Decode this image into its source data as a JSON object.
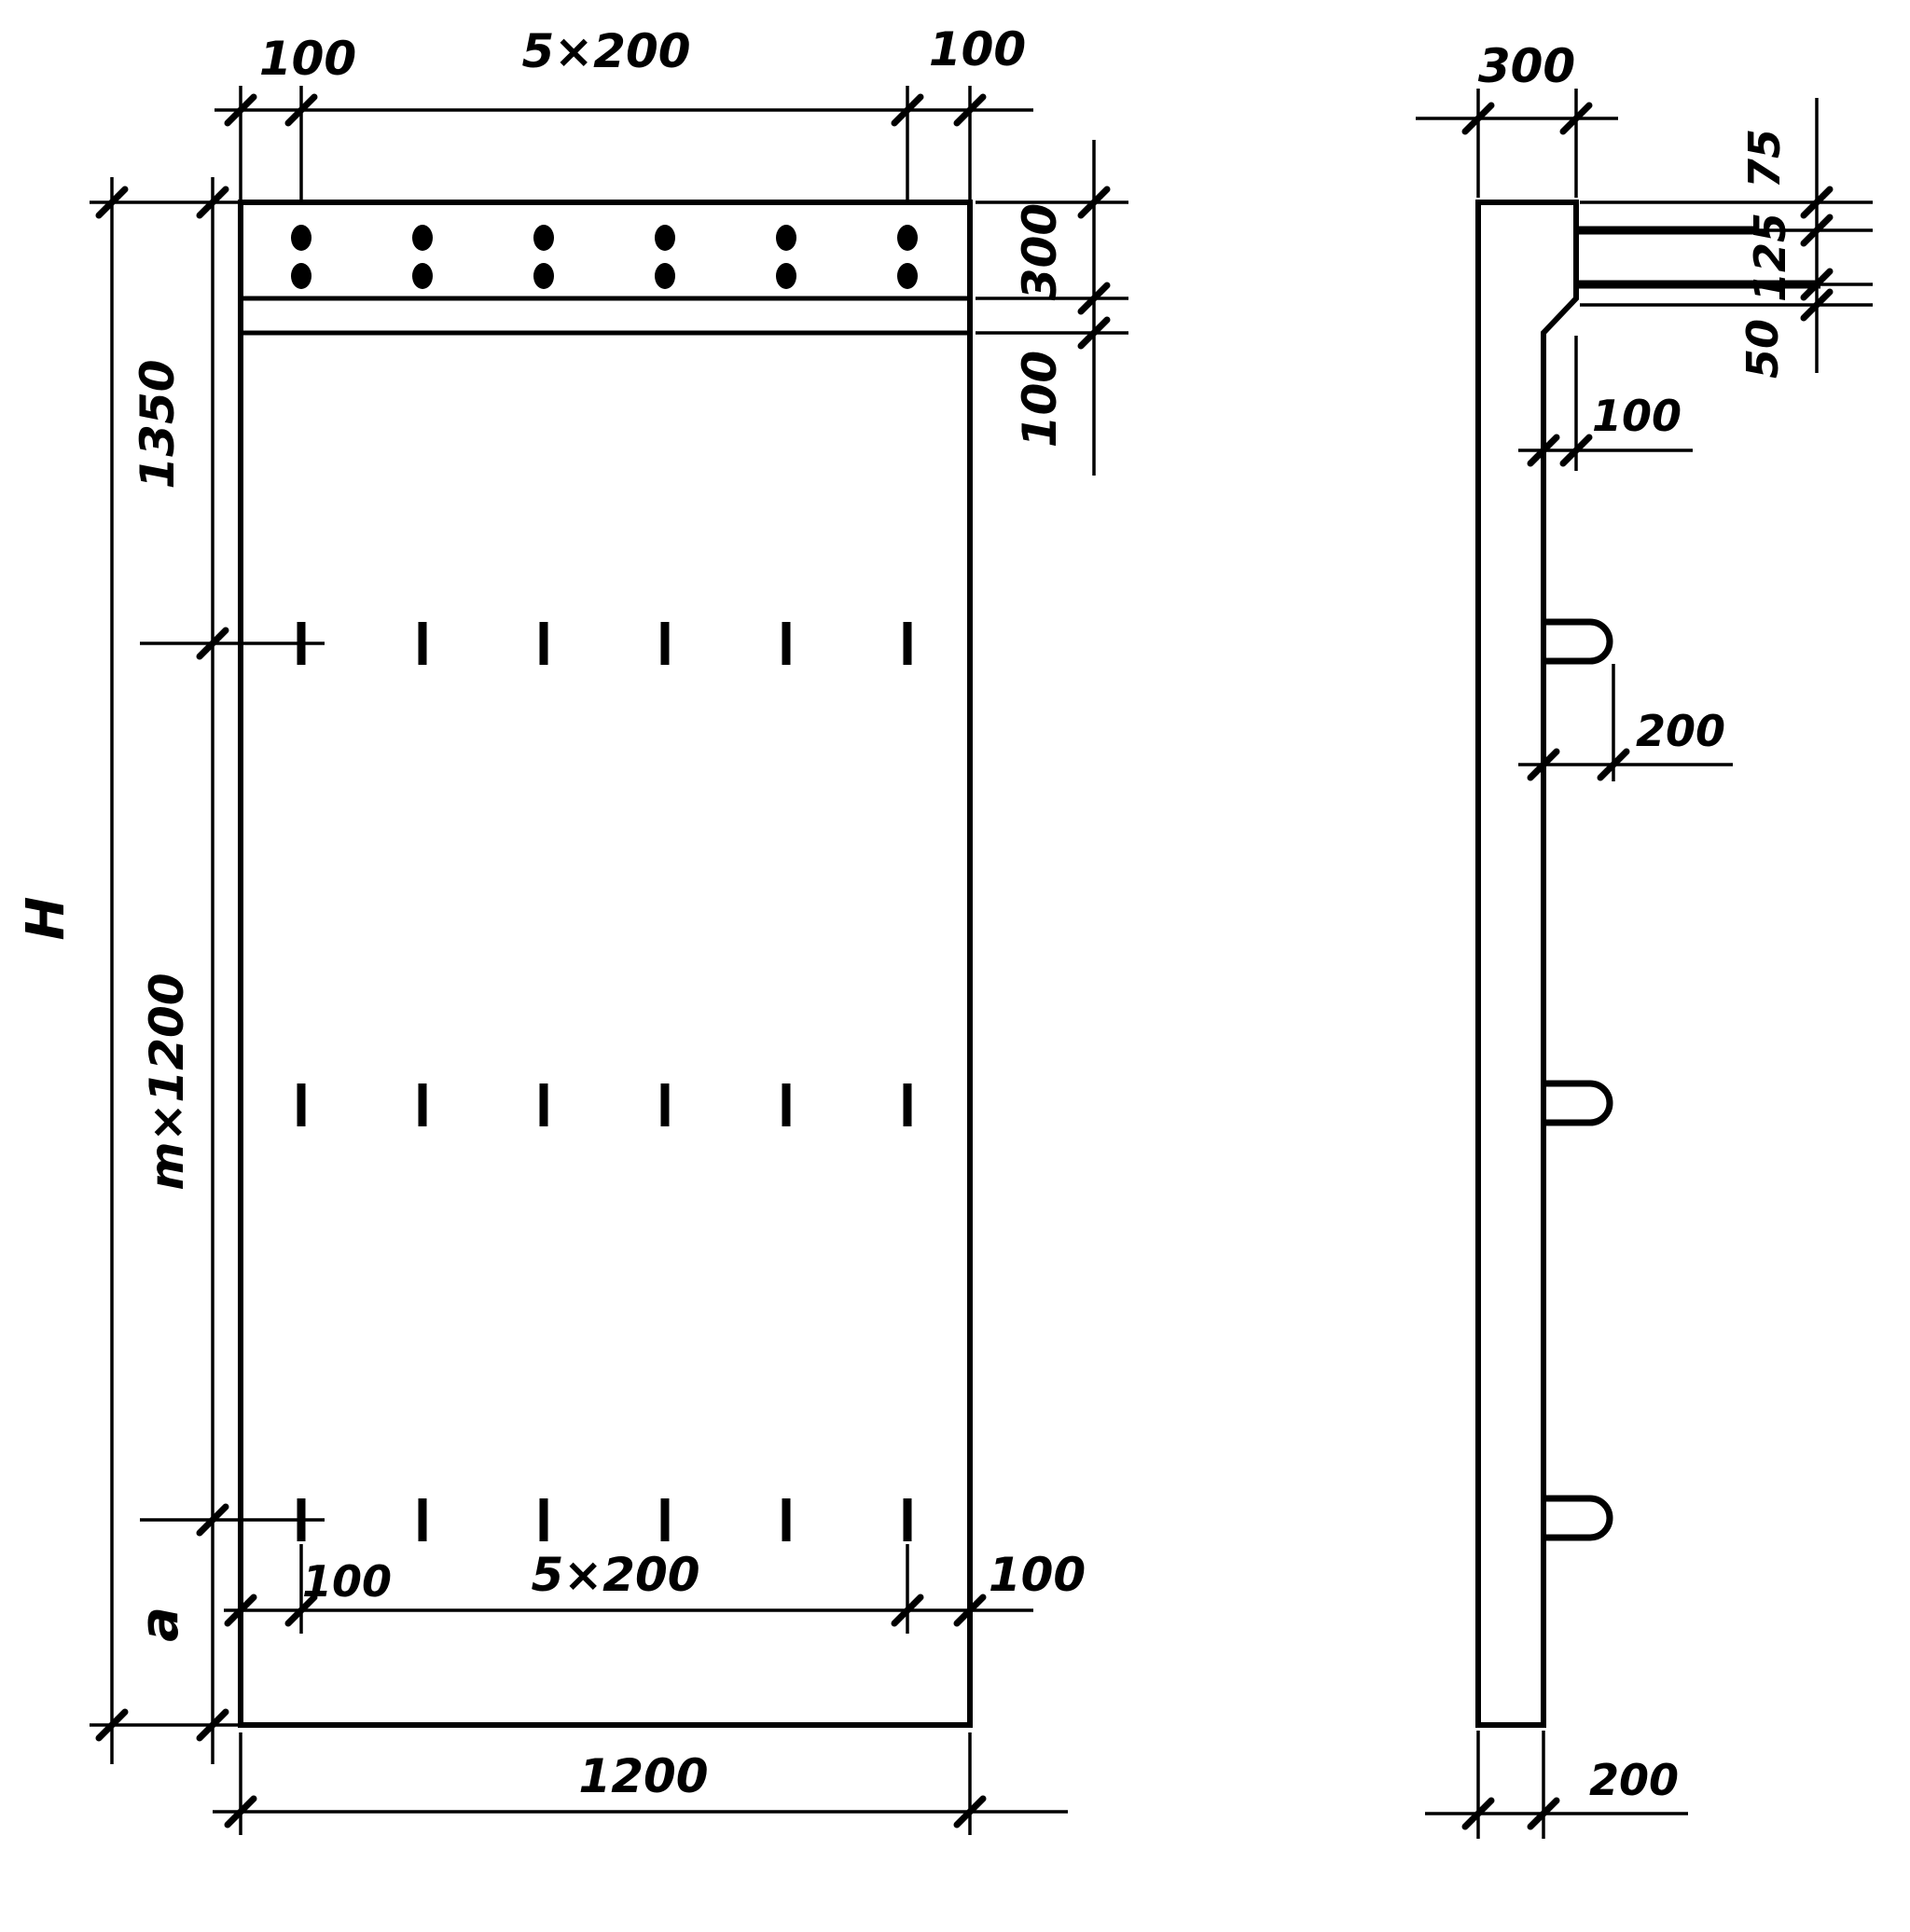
{
  "front_view": {
    "top": {
      "left_margin": "100",
      "spacing": "5×200",
      "right_margin": "100"
    },
    "right": {
      "flange_height": "300",
      "strip_height": "100"
    },
    "left": {
      "top_segment": "1350",
      "middle_segment": "m×1200",
      "bottom_segment": "a",
      "overall_height": "H"
    },
    "bottom": {
      "left_margin": "100",
      "spacing": "5×200",
      "right_margin": "100",
      "width": "1200"
    }
  },
  "side_view": {
    "top_depth": "300",
    "right": {
      "offset_top": "75",
      "offset_middle": "125",
      "offset_bottom": "50"
    },
    "wall_offset": "100",
    "hook_protrusion": "200",
    "bottom_thickness": "200"
  },
  "colors": {
    "ink": "#000000",
    "paper": "#ffffff"
  }
}
